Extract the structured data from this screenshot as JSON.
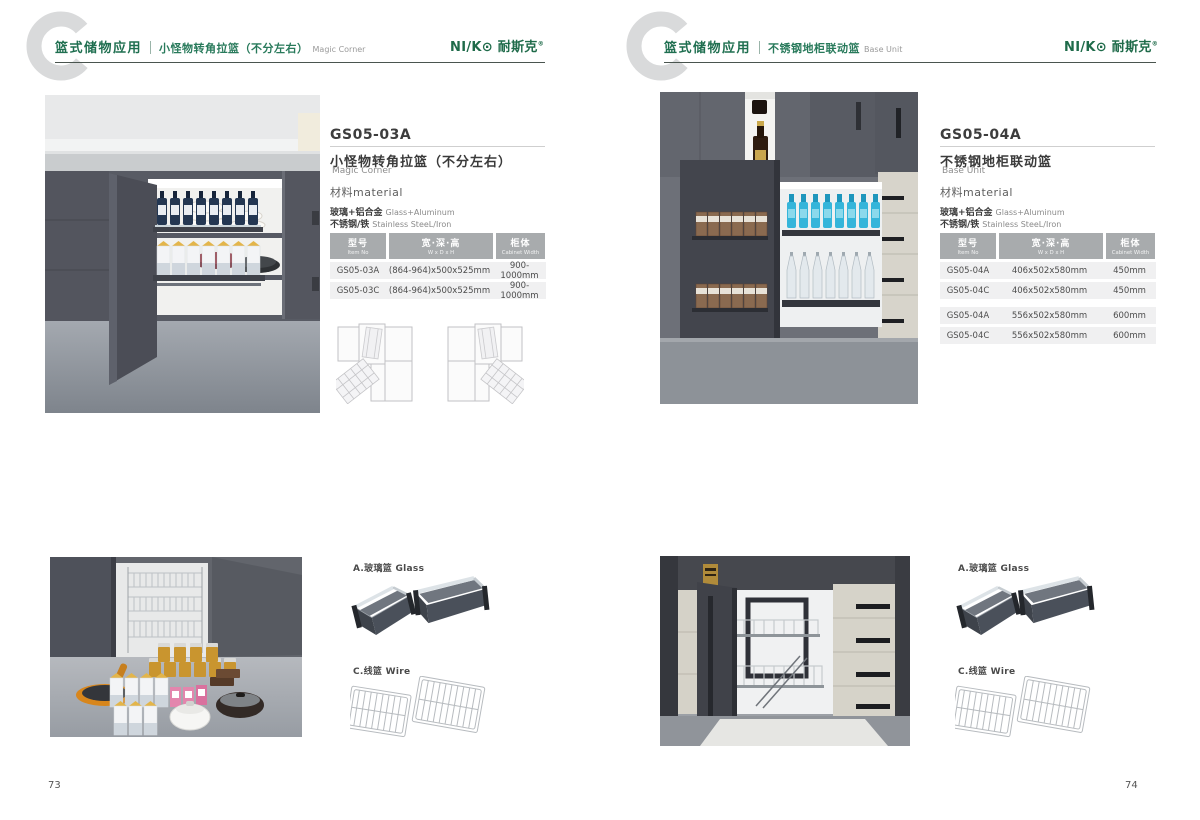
{
  "brand": {
    "logo_en": "NI/K⊙",
    "logo_cn": "耐斯克",
    "reg": "®"
  },
  "colors": {
    "brand_green": "#1f6b4a",
    "table_header_bg": "#a8abad",
    "row_bg": "#f0f0f1"
  },
  "pages": [
    {
      "page_no": "73",
      "header": {
        "category": "篮式储物应用",
        "title_cn": "小怪物转角拉篮（不分左右）",
        "title_en": "Magic Corner"
      },
      "product": {
        "model": "GS05-03A",
        "name_cn": "小怪物转角拉篮（不分左右）",
        "name_en": "Magic Corner",
        "material_heading": "材料material",
        "materials": [
          {
            "cn": "玻璃+铝合金",
            "en": "Glass+Aluminum"
          },
          {
            "cn": "不锈钢/铁",
            "en": "Stainless SteeL/Iron"
          }
        ]
      },
      "spec_table": {
        "headers": [
          {
            "cn": "型号",
            "en": "Item No"
          },
          {
            "cn": "宽·深·高",
            "en": "W x D x H"
          },
          {
            "cn": "柜体",
            "en": "Cabinet Width"
          }
        ],
        "rows": [
          {
            "model": "GS05-03A",
            "size": "(864-964)x500x525mm",
            "cabinet": "900-1000mm"
          },
          {
            "model": "GS05-03C",
            "size": "(864-964)x500x525mm",
            "cabinet": "900-1000mm"
          }
        ]
      },
      "accessories": {
        "glass_label": "A.玻璃篮 Glass",
        "wire_label": "C.线篮 Wire"
      }
    },
    {
      "page_no": "74",
      "header": {
        "category": "篮式储物应用",
        "title_cn": "不锈钢地柜联动篮",
        "title_en": "Base Unit"
      },
      "product": {
        "model": "GS05-04A",
        "name_cn": "不锈钢地柜联动篮",
        "name_en": "Base Unit",
        "material_heading": "材料material",
        "materials": [
          {
            "cn": "玻璃+铝合金",
            "en": "Glass+Aluminum"
          },
          {
            "cn": "不锈钢/铁",
            "en": "Stainless SteeL/Iron"
          }
        ]
      },
      "spec_table": {
        "headers": [
          {
            "cn": "型号",
            "en": "Item No"
          },
          {
            "cn": "宽·深·高",
            "en": "W x D x H"
          },
          {
            "cn": "柜体",
            "en": "Cabinet Width"
          }
        ],
        "rows": [
          {
            "model": "GS05-04A",
            "size": "406x502x580mm",
            "cabinet": "450mm"
          },
          {
            "model": "GS05-04C",
            "size": "406x502x580mm",
            "cabinet": "450mm"
          },
          {
            "model": "GS05-04A",
            "size": "556x502x580mm",
            "cabinet": "600mm"
          },
          {
            "model": "GS05-04C",
            "size": "556x502x580mm",
            "cabinet": "600mm"
          }
        ]
      },
      "accessories": {
        "glass_label": "A.玻璃篮 Glass",
        "wire_label": "C.线篮 Wire"
      }
    }
  ]
}
